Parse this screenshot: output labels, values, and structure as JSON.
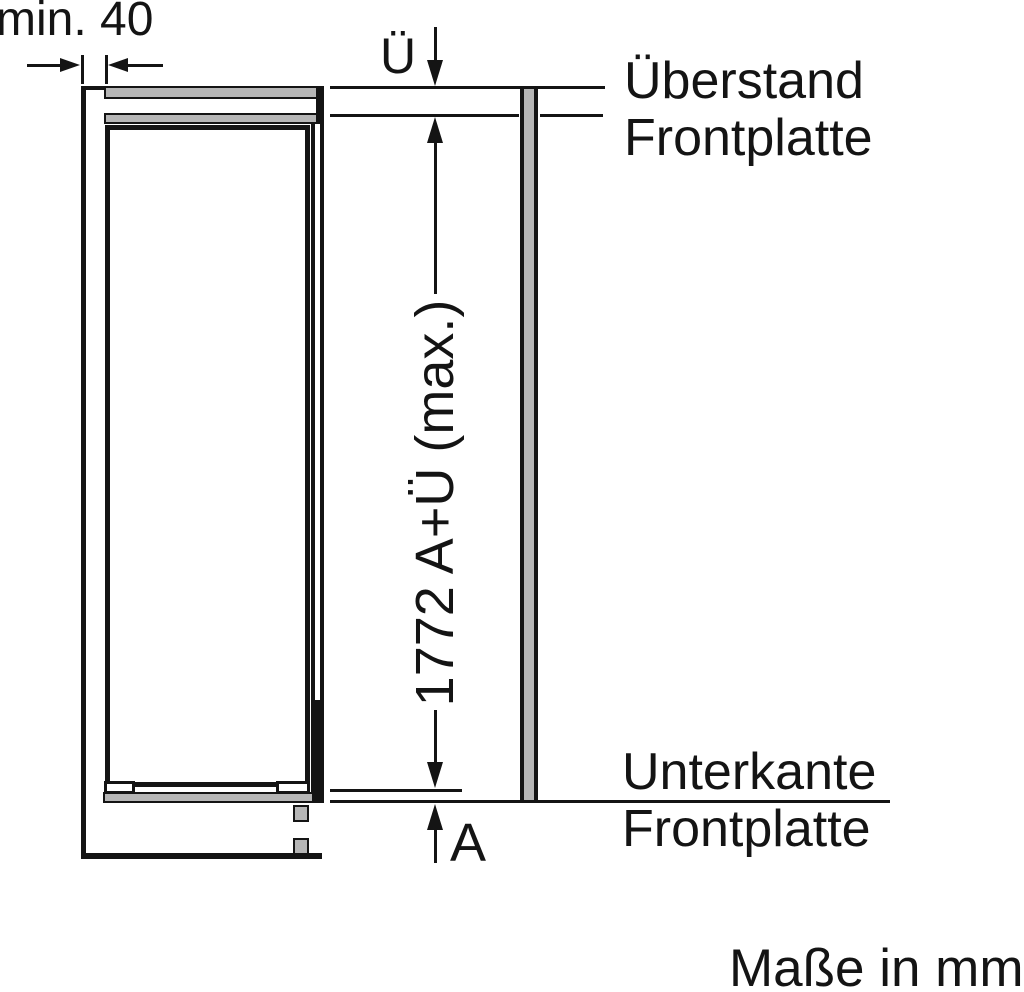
{
  "figure": {
    "units_note": "Maße in mm",
    "dimensions": {
      "min_clearance": "min. 40",
      "overhang_symbol": "Ü",
      "height_formula": "1772 A+Ü (max.)",
      "bottom_gap_symbol": "A"
    },
    "callouts": {
      "top": {
        "line1": "Überstand",
        "line2": "Frontplatte"
      },
      "bottom": {
        "line1": "Unterkante",
        "line2": "Frontplatte"
      }
    }
  },
  "colors": {
    "line": "#141414",
    "panel_fill": "#b6b6b6",
    "background": "#ffffff"
  }
}
